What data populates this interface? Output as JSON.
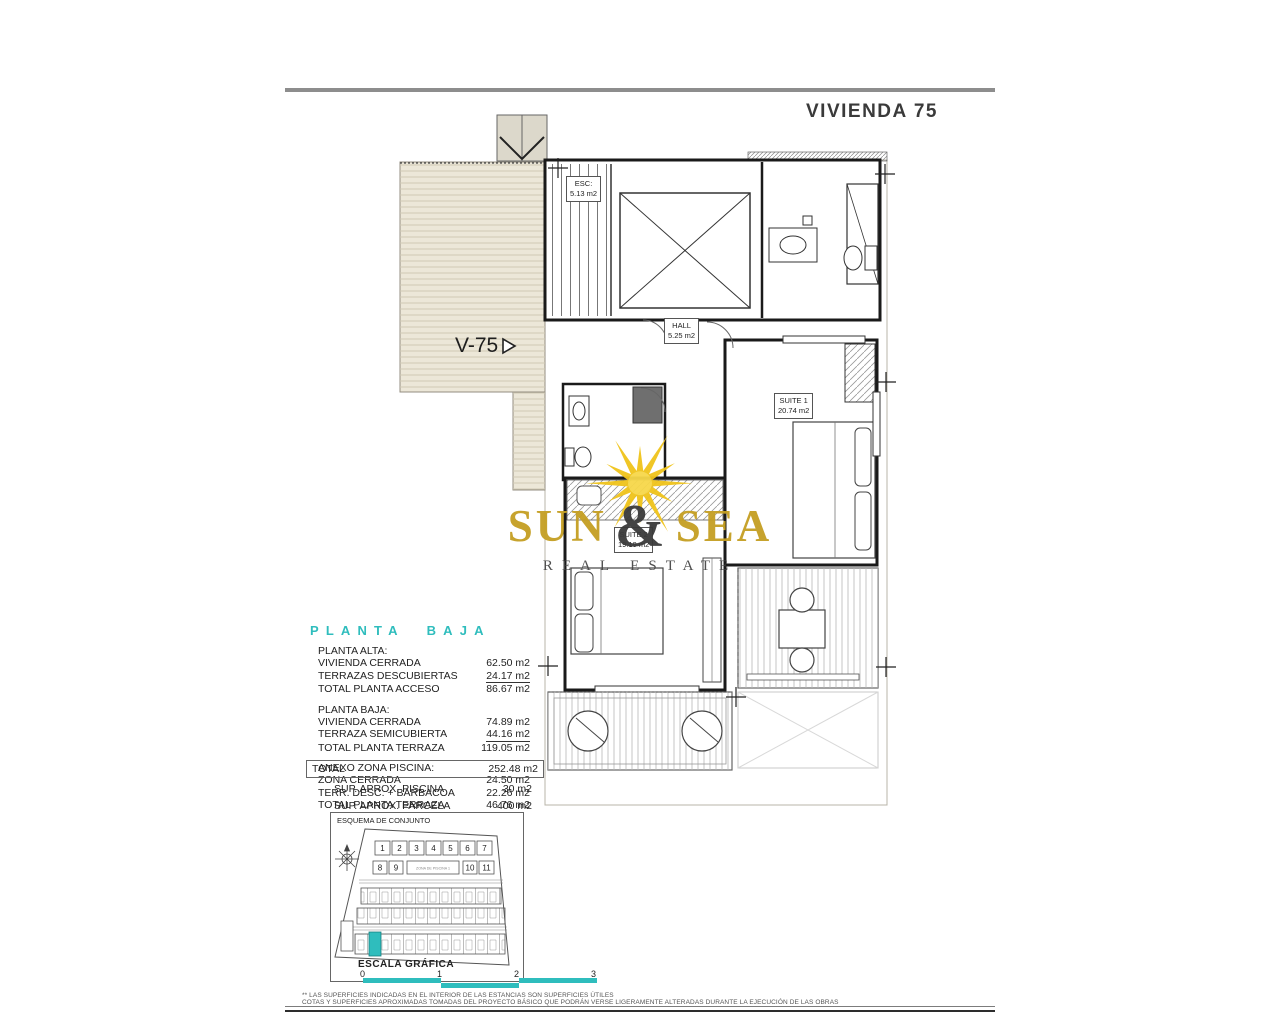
{
  "page": {
    "title": "VIVIENDA 75",
    "footnotes": [
      "** LAS SUPERFICIES INDICADAS EN EL INTERIOR DE LAS ESTANCIAS SON SUPERFICIES ÚTILES",
      "COTAS Y SUPERFICIES APROXIMADAS TOMADAS DEL PROYECTO BÁSICO QUE PODRÁN VERSE LIGERAMENTE ALTERADAS DURANTE LA EJECUCIÓN DE LAS OBRAS"
    ]
  },
  "plan": {
    "unit_label": "V-75",
    "rooms": {
      "esc": {
        "name": "ESC:",
        "area": "5.13 m2"
      },
      "hall": {
        "name": "HALL",
        "area": "5.25 m2"
      },
      "suite1": {
        "name": "SUITE 1",
        "area": "20.74 m2"
      },
      "suite2": {
        "name": "SUITE 2",
        "area": "19.19 m2"
      }
    }
  },
  "watermark": {
    "word1": "SUN",
    "amp": "&",
    "word2": "SEA",
    "subtitle": "REAL ESTATE"
  },
  "areas": {
    "heading": "PLANTA BAJA",
    "sections": [
      {
        "title": "PLANTA ALTA:",
        "rows": [
          {
            "label": "VIVIENDA CERRADA",
            "value": "62.50 m2"
          },
          {
            "label": "TERRAZAS DESCUBIERTAS",
            "value": "24.17 m2"
          },
          {
            "label": "TOTAL PLANTA ACCESO",
            "value": "86.67 m2"
          }
        ]
      },
      {
        "title": "PLANTA BAJA:",
        "rows": [
          {
            "label": "VIVIENDA CERRADA",
            "value": "74.89 m2"
          },
          {
            "label": "TERRAZA SEMICUBIERTA",
            "value": "44.16 m2"
          },
          {
            "label": "TOTAL PLANTA TERRAZA",
            "value": "119.05 m2"
          }
        ]
      },
      {
        "title": "ANEXO ZONA PISCINA:",
        "rows": [
          {
            "label": "ZONA CERRADA",
            "value": "24.50 m2"
          },
          {
            "label": "TERR. DESC. + BARBACOA",
            "value": "22.26 m2"
          },
          {
            "label": "TOTAL PLANTA TERRAZA",
            "value": "46.76 m2"
          }
        ]
      }
    ],
    "total": {
      "label": "TOTAL",
      "value": "252.48 m2"
    },
    "extras": [
      {
        "label": "SUP.  APROX.  PISCINA",
        "value": "30 m2"
      },
      {
        "label": "SUP.  APROX.  PARCELA",
        "value": "400 m2"
      }
    ]
  },
  "esquema": {
    "title": "ESQUEMA DE CONJUNTO",
    "row1": [
      "1",
      "2",
      "3",
      "4",
      "5",
      "6",
      "7"
    ],
    "row2": [
      "8",
      "9",
      "10",
      "11"
    ],
    "pool_label": "ZONA DE PISCINA 1"
  },
  "escala": {
    "title": "ESCALA GRÁFICA",
    "ticks": [
      "0",
      "1",
      "2",
      "3"
    ]
  },
  "colors": {
    "teal": "#2fbdbd",
    "gold": "#c59f22",
    "sun": "#f0c41b",
    "terrace_beige": "#ece7d8"
  }
}
